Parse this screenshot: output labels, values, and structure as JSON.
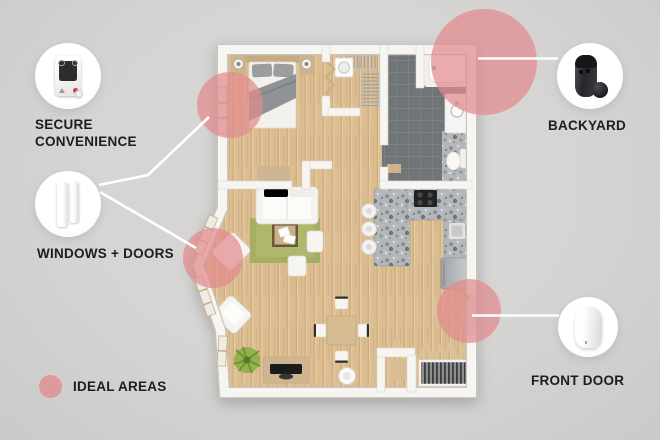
{
  "title": "home security ideal areas floor plan",
  "colors": {
    "background": "#d1d1d1",
    "ideal_area_pink": "#e18a8e",
    "connector_line": "#ffffff",
    "text": "#1d1d1d",
    "wall": "#f7f5f2",
    "wood_floor": "#dcbd92",
    "bathroom_tile": "#707477",
    "granite": "#b4b7b9",
    "rug_green": "#a5ae63"
  },
  "callouts": [
    {
      "id": "secure-convenience",
      "icon": "keyfob-icon",
      "lines": [
        "SECURE",
        "CONVENIENCE"
      ]
    },
    {
      "id": "windows-doors",
      "icon": "door-window-sensors-icon",
      "lines": [
        "WINDOWS + DOORS"
      ]
    },
    {
      "id": "backyard",
      "icon": "outdoor-camera-icon",
      "lines": [
        "BACKYARD"
      ]
    },
    {
      "id": "front-door",
      "icon": "indoor-camera-icon",
      "lines": [
        "FRONT DOOR"
      ]
    }
  ],
  "legend": {
    "swatch": "ideal-area-marker",
    "label": "IDEAL AREAS"
  },
  "floorplan": {
    "rooms": [
      "bedroom",
      "closet",
      "bathroom",
      "kitchen",
      "living room",
      "dining area",
      "entry"
    ],
    "ideal_areas": [
      "bedroom window",
      "backyard bathroom corner",
      "living room window",
      "front door"
    ]
  }
}
